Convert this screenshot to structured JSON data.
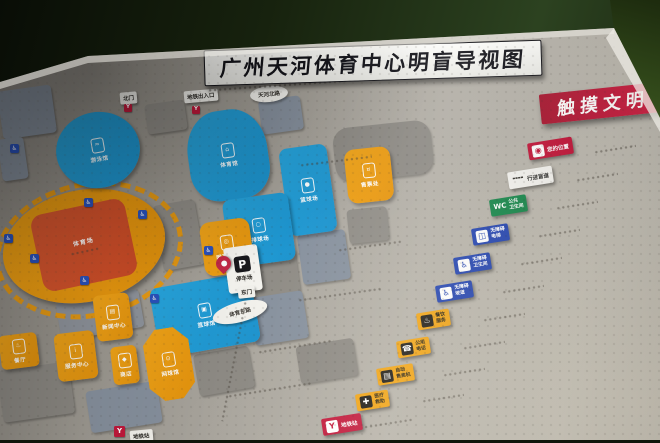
{
  "colors": {
    "board": "#aaa69f",
    "accent_red": "#c2183b",
    "legend_blue": "#2243b0",
    "legend_green": "#15864a",
    "legend_yellow": "#f0a314",
    "venue_blue": "#1f9ed8",
    "venue_orange": "#efa012",
    "stadium_field": "#d4512c",
    "grass": "#6f9440"
  },
  "plates": {
    "title": "广州天河体育中心明盲导视图",
    "touch": "触摸文明"
  },
  "legend": {
    "items": [
      {
        "name": "your-location",
        "glyph": "◉",
        "line1": "您的位置"
      },
      {
        "name": "tactile-path",
        "glyph": "╍╍",
        "line1": "行进盲道"
      },
      {
        "name": "public-toilet",
        "glyph": "WC",
        "line1": "公共",
        "line2": "卫生间"
      },
      {
        "name": "accessible-elevator",
        "glyph": "◫",
        "line1": "无障碍",
        "line2": "电梯"
      },
      {
        "name": "accessible-toilet",
        "glyph": "♿",
        "line1": "无障碍",
        "line2": "卫生间"
      },
      {
        "name": "accessible-ramp",
        "glyph": "♿",
        "line1": "无障碍",
        "line2": "坡道"
      },
      {
        "name": "dining-service",
        "glyph": "♨",
        "line1": "餐饮",
        "line2": "服务"
      },
      {
        "name": "public-telephone",
        "glyph": "☎",
        "line1": "公用",
        "line2": "电话"
      },
      {
        "name": "vending-machine",
        "glyph": "▤",
        "line1": "自动",
        "line2": "售卖机"
      },
      {
        "name": "first-aid",
        "glyph": "✚",
        "line1": "医疗",
        "line2": "救助"
      },
      {
        "name": "metro-station",
        "glyph": "Y",
        "line1": "地铁站"
      }
    ]
  },
  "map": {
    "stadium": {
      "label": "体育场"
    },
    "venues": [
      {
        "name": "natatorium",
        "label": "游泳馆",
        "glyph": "≈"
      },
      {
        "name": "gymnasium",
        "label": "体育馆",
        "glyph": "⌂"
      },
      {
        "name": "basketball-court",
        "label": "篮球场",
        "glyph": "●"
      },
      {
        "name": "volleyball-court",
        "label": "排球场",
        "glyph": "○"
      },
      {
        "name": "basketball-hall",
        "label": "篮球馆",
        "glyph": "▣"
      },
      {
        "name": "tennis-center",
        "label": "网球中心",
        "glyph": "◎"
      },
      {
        "name": "ticket-office",
        "label": "售票处",
        "glyph": "¤"
      },
      {
        "name": "news-center",
        "label": "新闻中心",
        "glyph": "▤"
      },
      {
        "name": "service-center",
        "label": "服务中心",
        "glyph": "i"
      },
      {
        "name": "shop",
        "label": "商店",
        "glyph": "◆"
      },
      {
        "name": "tennis-hall",
        "label": "网球馆",
        "glyph": "⊙"
      },
      {
        "name": "restaurant",
        "label": "餐厅",
        "glyph": "♨"
      }
    ],
    "parking": {
      "symbol": "P",
      "label": "停车场"
    },
    "gates": {
      "north": "北门",
      "metro_entrance": "地铁出入口",
      "east": "东门"
    },
    "roads": {
      "north": "天河北路",
      "east": "体育东路"
    },
    "metro_station_label": "地铁站",
    "icons": {
      "accessibility_glyph": "♿",
      "metro_glyph": "Y"
    }
  }
}
